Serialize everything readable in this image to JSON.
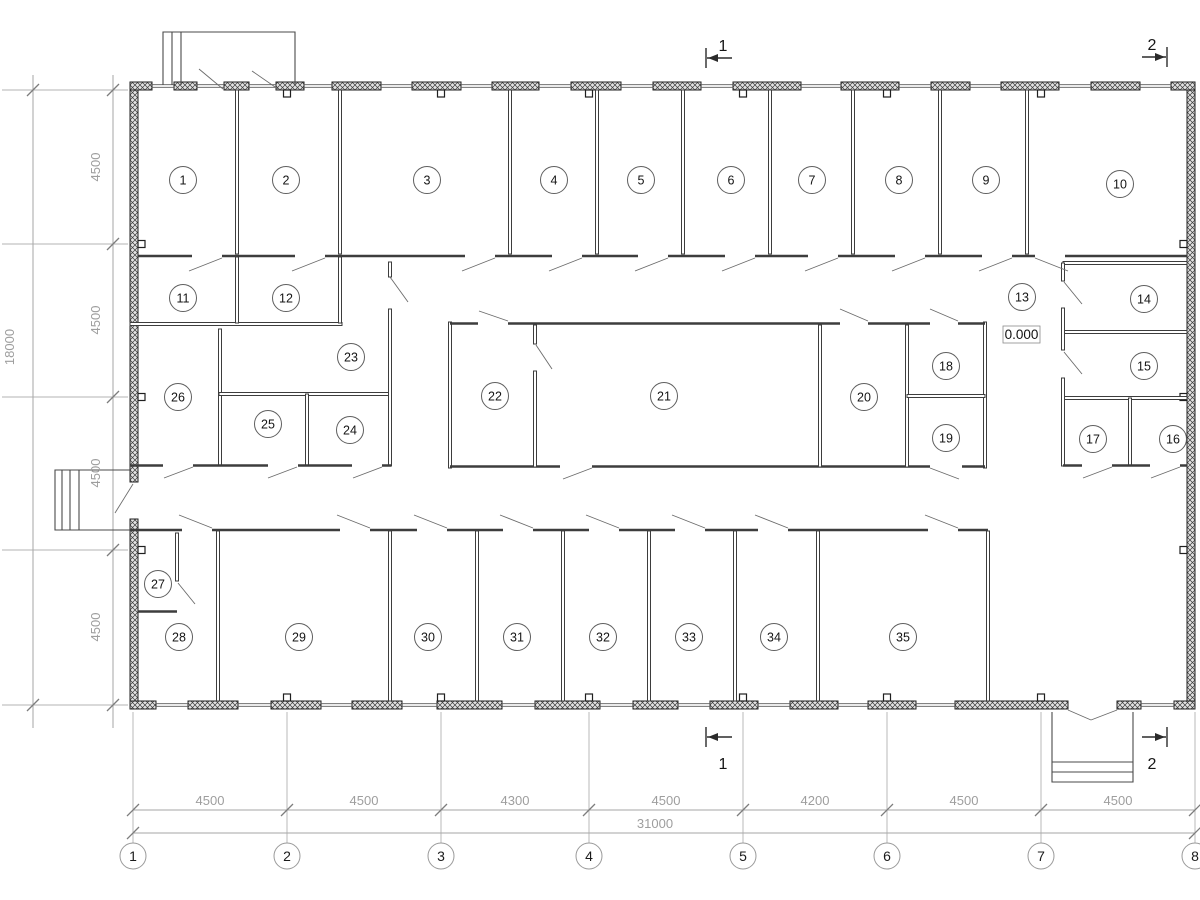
{
  "plan": {
    "rooms": [
      {
        "n": "1",
        "x": 183,
        "y": 180
      },
      {
        "n": "2",
        "x": 286,
        "y": 180
      },
      {
        "n": "3",
        "x": 427,
        "y": 180
      },
      {
        "n": "4",
        "x": 554,
        "y": 180
      },
      {
        "n": "5",
        "x": 641,
        "y": 180
      },
      {
        "n": "6",
        "x": 731,
        "y": 180
      },
      {
        "n": "7",
        "x": 812,
        "y": 180
      },
      {
        "n": "8",
        "x": 899,
        "y": 180
      },
      {
        "n": "9",
        "x": 986,
        "y": 180
      },
      {
        "n": "10",
        "x": 1120,
        "y": 184
      },
      {
        "n": "11",
        "x": 183,
        "y": 298
      },
      {
        "n": "12",
        "x": 286,
        "y": 298
      },
      {
        "n": "13",
        "x": 1022,
        "y": 297
      },
      {
        "n": "14",
        "x": 1144,
        "y": 299
      },
      {
        "n": "15",
        "x": 1144,
        "y": 366
      },
      {
        "n": "16",
        "x": 1173,
        "y": 439
      },
      {
        "n": "17",
        "x": 1093,
        "y": 439
      },
      {
        "n": "18",
        "x": 946,
        "y": 366
      },
      {
        "n": "19",
        "x": 946,
        "y": 438
      },
      {
        "n": "20",
        "x": 864,
        "y": 397
      },
      {
        "n": "21",
        "x": 664,
        "y": 396
      },
      {
        "n": "22",
        "x": 495,
        "y": 396
      },
      {
        "n": "23",
        "x": 351,
        "y": 357
      },
      {
        "n": "24",
        "x": 350,
        "y": 430
      },
      {
        "n": "25",
        "x": 268,
        "y": 424
      },
      {
        "n": "26",
        "x": 178,
        "y": 397
      },
      {
        "n": "27",
        "x": 158,
        "y": 584
      },
      {
        "n": "28",
        "x": 179,
        "y": 637
      },
      {
        "n": "29",
        "x": 299,
        "y": 637
      },
      {
        "n": "30",
        "x": 428,
        "y": 637
      },
      {
        "n": "31",
        "x": 517,
        "y": 637
      },
      {
        "n": "32",
        "x": 603,
        "y": 637
      },
      {
        "n": "33",
        "x": 689,
        "y": 637
      },
      {
        "n": "34",
        "x": 774,
        "y": 637
      },
      {
        "n": "35",
        "x": 903,
        "y": 637
      }
    ],
    "grid": {
      "y": 856,
      "bubbles": [
        {
          "label": "1",
          "x": 133
        },
        {
          "label": "2",
          "x": 287
        },
        {
          "label": "3",
          "x": 441
        },
        {
          "label": "4",
          "x": 589
        },
        {
          "label": "5",
          "x": 743
        },
        {
          "label": "6",
          "x": 887
        },
        {
          "label": "7",
          "x": 1041
        },
        {
          "label": "8",
          "x": 1195
        }
      ]
    },
    "dims_bottom": {
      "y": 805,
      "chain": [
        {
          "label": "4500",
          "x": 210
        },
        {
          "label": "4500",
          "x": 364
        },
        {
          "label": "4300",
          "x": 515
        },
        {
          "label": "4500",
          "x": 666
        },
        {
          "label": "4200",
          "x": 815
        },
        {
          "label": "4500",
          "x": 964
        },
        {
          "label": "4500",
          "x": 1118
        }
      ],
      "total": {
        "label": "31000",
        "x": 655,
        "y": 828
      }
    },
    "dims_left": {
      "x": 100,
      "chain": [
        {
          "label": "4500",
          "y": 167
        },
        {
          "label": "4500",
          "y": 320
        },
        {
          "label": "4500",
          "y": 473
        },
        {
          "label": "4500",
          "y": 627
        }
      ],
      "total": {
        "label": "18000",
        "x": 14,
        "y": 347
      }
    },
    "section_markers": [
      {
        "label": "1",
        "x": 706,
        "y": 58,
        "dir": "left",
        "lx": 723,
        "ly": 51
      },
      {
        "label": "2",
        "x": 1167,
        "y": 57,
        "dir": "right",
        "lx": 1152,
        "ly": 50
      },
      {
        "label": "1",
        "x": 706,
        "y": 737,
        "dir": "left",
        "lx": 723,
        "ly": 769
      },
      {
        "label": "2",
        "x": 1167,
        "y": 737,
        "dir": "right",
        "lx": 1152,
        "ly": 769
      }
    ],
    "level_marker": {
      "label": "0.000"
    }
  }
}
